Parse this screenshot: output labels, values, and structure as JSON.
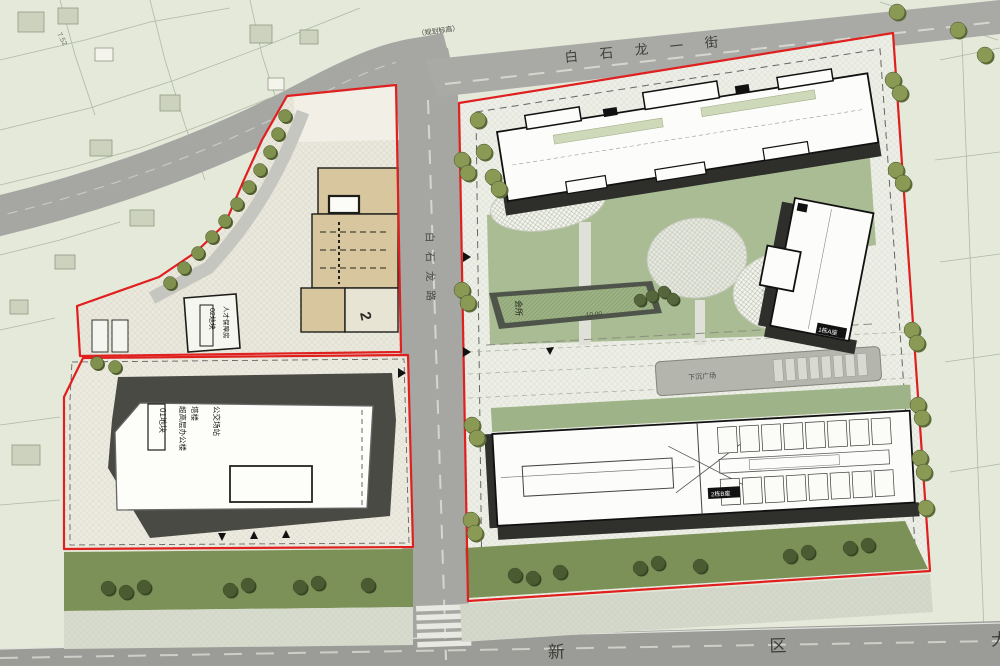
{
  "roads": {
    "top_street": "白 石 龙 一 街",
    "middle_road": "白石龙路",
    "bottom_avenue": "新 区 大 道",
    "elevation_note": "（规划标高）"
  },
  "plots": {
    "plot01": {
      "label": "01地块",
      "line1": "超高层办公楼",
      "line2": "塔楼",
      "line3": "公交场站"
    },
    "plot02": {
      "label": "02地块",
      "line1": "人才保障房",
      "unit_number": "2"
    }
  },
  "buildings": {
    "clubhouse": "会所",
    "tower_a": "1栋A座",
    "block_b": "2栋B座"
  },
  "annotations": {
    "fire_area_1": "消防登高车场地",
    "fire_area_2": "消防登高车场地",
    "sunken_plaza": "下沉广场",
    "elev_clubhouse": "10.00",
    "elev_plaza": "3.67",
    "elev_survey": "7.52"
  },
  "colors": {
    "boundary_red": "#e01f1f",
    "road_gray": "#a6a6a3",
    "lawn_green": "#7c9157",
    "courtyard_green": "#a9bc94",
    "podium_tan": "#d8c79e",
    "building_white": "#fcfcfa",
    "shadow_dark": "#2e2e2b",
    "background": "#e4e9da"
  }
}
